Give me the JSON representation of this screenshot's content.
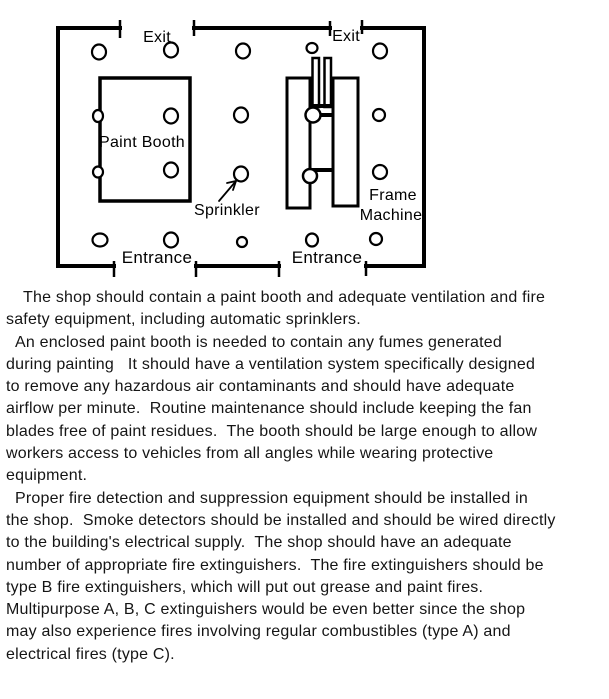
{
  "page": {
    "background_color": "#ffffff",
    "ink_color": "#000000"
  },
  "diagram": {
    "exit_labels": [
      "Exit",
      "Exit"
    ],
    "entrance_labels": [
      "Entrance",
      "Entrance"
    ],
    "paint_booth_label": "Paint Booth",
    "sprinkler_label": "Sprinkler",
    "frame_machine_label": [
      "Frame",
      "Machine"
    ],
    "sprinkler_count": 20
  },
  "body": {
    "paragraphs": [
      {
        "lines": [
          "The shop should contain a paint booth and adequate ventilation and fire",
          "safety equipment, including automatic sprinklers."
        ]
      },
      {
        "lines": [
          "An enclosed paint booth is needed to contain any fumes generated",
          "during painting   It should have a ventilation system specifically designed",
          "to remove any hazardous air contaminants and should have adequate",
          "airflow per minute.  Routine maintenance should include keeping the fan",
          "blades free of paint residues.  The booth should be large enough to allow",
          "workers access to vehicles from all angles while wearing protective",
          "equipment."
        ]
      },
      {
        "lines": [
          "Proper fire detection and suppression equipment should be installed in",
          "the shop.  Smoke detectors should be installed and should be wired directly",
          "to the building's electrical supply.  The shop should have an adequate",
          "number of appropriate fire extinguishers.  The fire extinguishers should be",
          "type B fire extinguishers, which will put out grease and paint fires.",
          "Multipurpose A, B, C extinguishers would be even better since the shop",
          "may also experience fires involving regular combustibles (type A) and",
          "electrical fires (type C)."
        ]
      }
    ]
  }
}
